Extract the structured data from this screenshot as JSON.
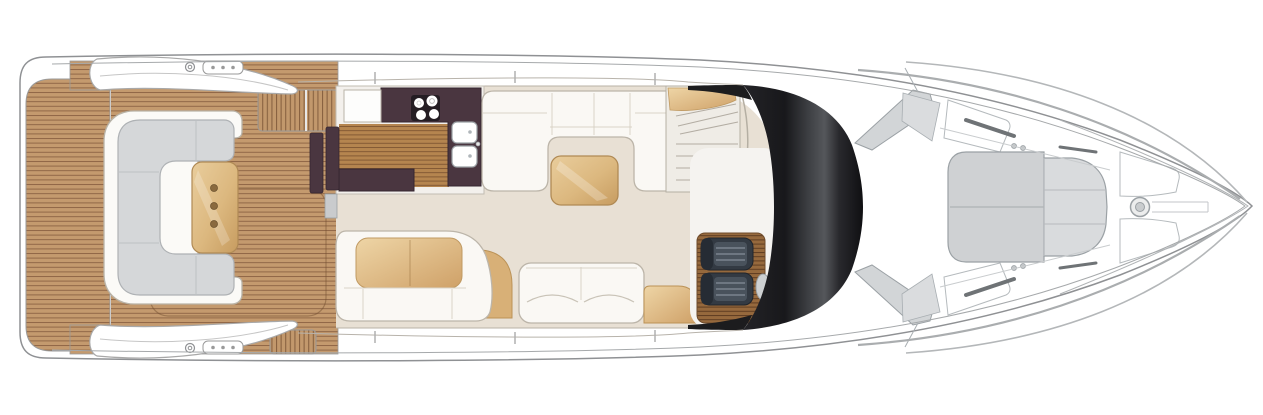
{
  "meta": {
    "title": "Motor Yacht Main Deck Floor Plan",
    "type": "deck-plan",
    "orientation": "bow-right, stern-left, top-down view"
  },
  "palette": {
    "teak": "#c49a6e",
    "teak_line": "#8b6243",
    "teak_galley": "#b5854f",
    "teak_helm": "#96693d",
    "counter_aubergine": "#4a3640",
    "cooktop_panel": "#241d23",
    "floor_beige": "#e8e0d4",
    "upholstery_cream": "#faf8f4",
    "upholstery_gray": "#d5d7d9",
    "upholstery_tan": "#ddb67f",
    "sunpad_gray": "#d0d2d4",
    "windshield_dark": "#1c1c1f",
    "frame_gray": "#d2d5d7",
    "outline_gray": "#8f9194"
  },
  "regions": {
    "hull": {
      "label": "Hull outline with sheer and rubrail lines"
    },
    "swim_platform": {
      "label": "Teak swim platform at stern"
    },
    "aft_cockpit": {
      "label": "Aft cockpit with teak sole and boarding steps"
    },
    "cockpit_sofa": {
      "label": "Cockpit C-shaped sofa with gray cushions"
    },
    "cockpit_table": {
      "label": "Cockpit teak table with three recesses"
    },
    "hardtop_supports": {
      "label": "Hardtop support wings over cockpit"
    },
    "galley": {
      "label": "Aft galley with aubergine worktops"
    },
    "cooktop": {
      "label": "Four-burner cooktop"
    },
    "sinks": {
      "label": "Twin galley sinks"
    },
    "salon": {
      "label": "Main deck salon"
    },
    "salon_sofa_u": {
      "label": "U-shaped salon sofa"
    },
    "coffee_table": {
      "label": "Salon coffee table"
    },
    "dinette": {
      "label": "Port salon sofa with tan back cushions"
    },
    "sofa_two_seat": {
      "label": "Two-seat salon sofa"
    },
    "side_cabinet": {
      "label": "Tan corner cabinet"
    },
    "staircase": {
      "label": "Companionway stairs to lower deck"
    },
    "helm": {
      "label": "Helm station with twin seats on teak plinth"
    },
    "windshield": {
      "label": "Dark wraparound windscreen"
    },
    "windshield_frame": {
      "label": "Windscreen A-pillar frames"
    },
    "foredeck": {
      "label": "Foredeck sun pad"
    },
    "bow": {
      "label": "Bow with hatches and anchor windlass"
    }
  },
  "details": {
    "cooktop_burners": 4,
    "galley_sinks": 2,
    "helm_seats": 2,
    "cockpit_table_recesses": 3,
    "straight_stair_treads": 4,
    "fan_stair_treads": 3,
    "sunpad_sections": 5,
    "bow_hatches": 2,
    "deck_fittings_per_side": 2
  }
}
